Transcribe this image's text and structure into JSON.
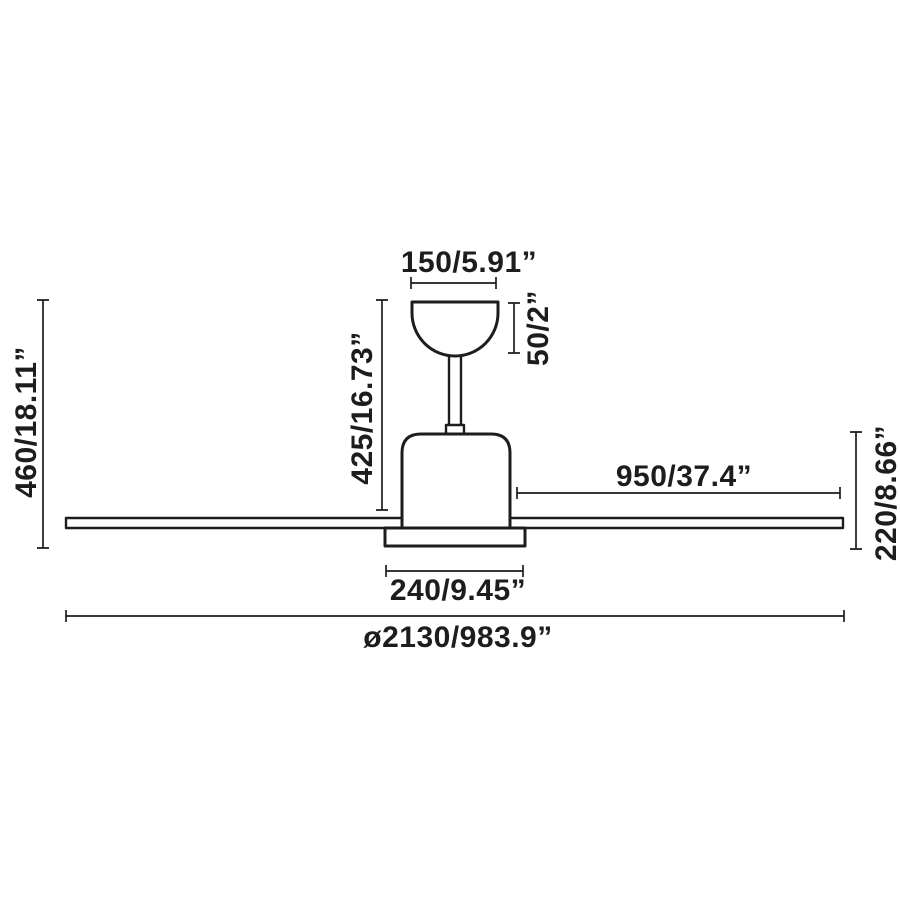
{
  "page": {
    "background_color": "#ffffff",
    "ink_color": "#1d1d1b"
  },
  "diagram": {
    "dimensions": {
      "canopy_width": {
        "label": "150/5.91”"
      },
      "canopy_height": {
        "label": "50/2”"
      },
      "drop_height": {
        "label": "425/16.73”"
      },
      "total_height": {
        "label": "460/18.11”"
      },
      "blade_length": {
        "label": "950/37.4”"
      },
      "body_height": {
        "label": "220/8.66”"
      },
      "body_width": {
        "label": "240/9.45”"
      },
      "sweep_diameter": {
        "label": "ø2130/983.9”"
      }
    }
  }
}
